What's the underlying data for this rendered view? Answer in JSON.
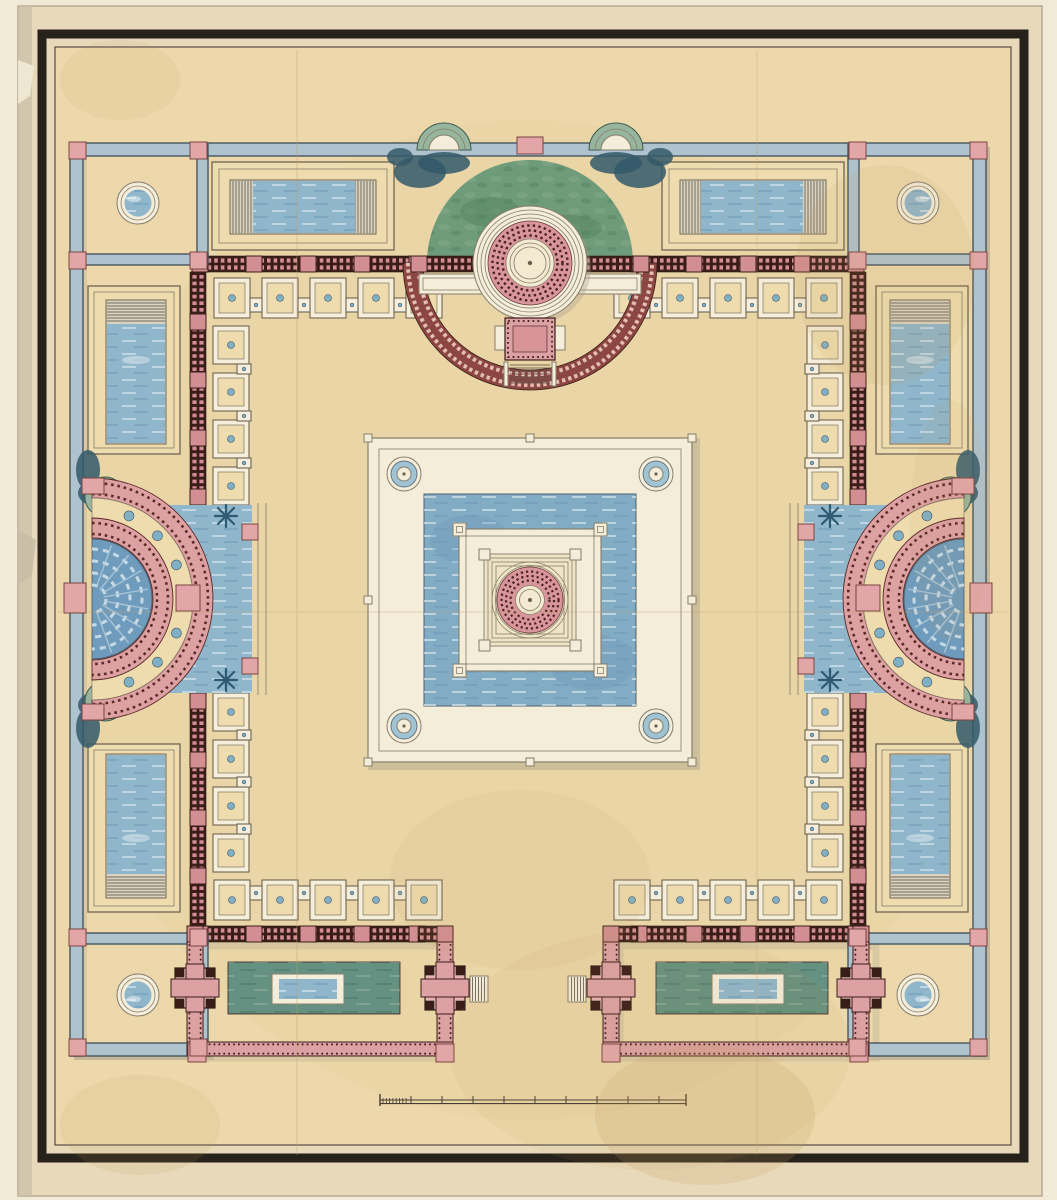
{
  "artwork": {
    "kind": "watercolor-and-ink architectural ground plan, symmetrical villa/bath complex",
    "visible_text": [],
    "scale_bar": {
      "present": true,
      "major_ticks": 10,
      "subdivided_left_segment": true
    },
    "inventory": {
      "corner_pavilions_with_round_pools": 4,
      "long_halls_with_rect_pools_top": 2,
      "side_halls_with_rect_pools": 4,
      "bottom_courts_with_green_pools": 2,
      "small_square_rooms": 36,
      "semicircular_exedrae": 3,
      "exedra_blue_marker_circles_per_side": 7,
      "central_water_basin": 1,
      "central_round_pavilion": 1,
      "corner_rosettes_central_walkway": 4,
      "star_shaped_plants": 4
    },
    "palette": {
      "paper": "#f1ead6",
      "sheet": "#e8d9ba",
      "sheet_edge": "#c9bda6",
      "plan_field": "#ecd8ab",
      "frame": "#26211a",
      "frame_inner": "#554c3f",
      "wall_line": "#46555f",
      "wall_fill": "#aec3cd",
      "wall_shadow": "#a59d89",
      "pier_pink": "#e2a6a8",
      "pier_outline": "#7c4442",
      "colonnade_dark": "#3a1d17",
      "colonnade_dot": "#d28e92",
      "court_band": "#dda1a4",
      "room_line": "#6e6452",
      "room_white": "#f5eedb",
      "room_fill": "#eedcae",
      "dot_blue": "#7fb0c6",
      "water": "#8fb6ca",
      "water_deep": "#6d98b6",
      "water_light": "#cfe0ea",
      "basin": "#82abc4",
      "lawn": "#6e9b79",
      "lawn_dark": "#51805f",
      "foliage": "#33596a",
      "celadon": "#97b49d",
      "pool_green": "#649181",
      "pool_green_dark": "#4e7a6b",
      "rotunda_pink": "#d8959c",
      "rotunda_dot": "#4a2320",
      "gallery_white": "#f3edda",
      "gallery_line": "#867d6a",
      "stair_line": "#5a5349",
      "stain": "#c49a5e",
      "crease": "#c2a274",
      "scalebar": "#453d32",
      "star_blue": "#2e5a74",
      "fan_blue": "#6f9cbc",
      "fan_light": "#c6dae6",
      "arc_brick": "#8d4742",
      "arc_brick_dot": "#e4beb5"
    }
  }
}
